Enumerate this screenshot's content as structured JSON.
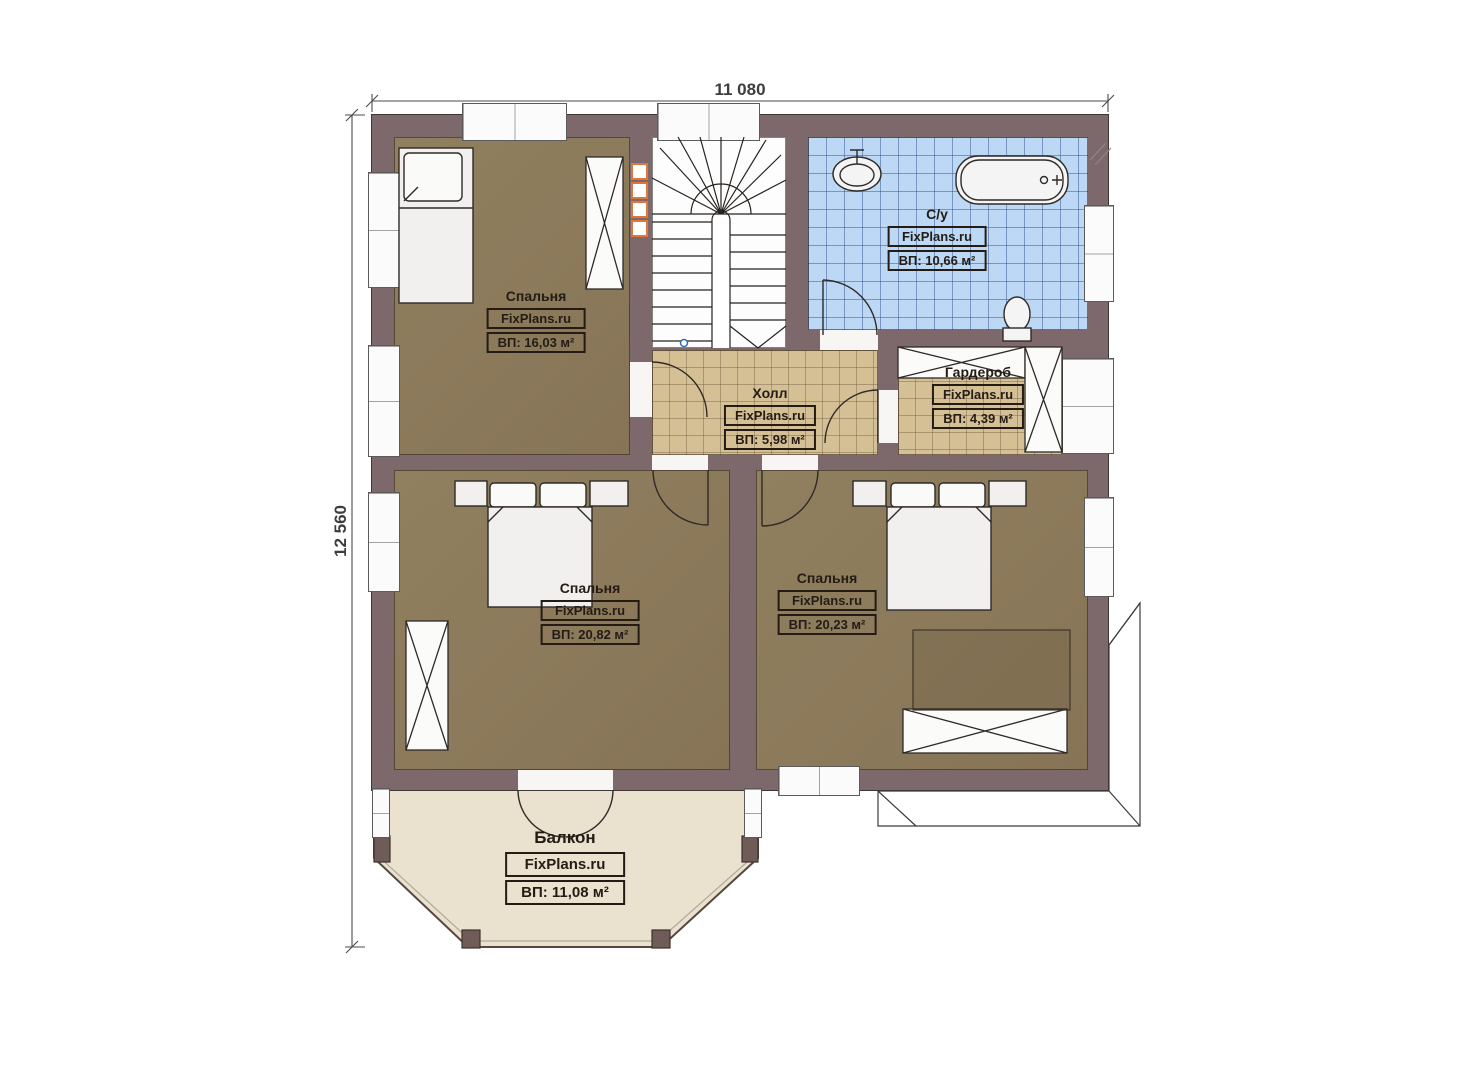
{
  "watermark": "FixPlans.ru",
  "dimensions": {
    "top": "11 080",
    "left": "12 560"
  },
  "rooms": [
    {
      "key": "bedroom_top_left",
      "name": "Спальня",
      "watermark": "FixPlans.ru",
      "area": "ВП: 16,03 м²"
    },
    {
      "key": "bathroom",
      "name": "С/у",
      "watermark": "FixPlans.ru",
      "area": "ВП: 10,66 м²"
    },
    {
      "key": "hall",
      "name": "Холл",
      "watermark": "FixPlans.ru",
      "area": "ВП: 5,98 м²"
    },
    {
      "key": "wardrobe",
      "name": "Гардероб",
      "watermark": "FixPlans.ru",
      "area": "ВП: 4,39 м²"
    },
    {
      "key": "bedroom_bottom_left",
      "name": "Спальня",
      "watermark": "FixPlans.ru",
      "area": "ВП: 20,82 м²"
    },
    {
      "key": "bedroom_bottom_right",
      "name": "Спальня",
      "watermark": "FixPlans.ru",
      "area": "ВП: 20,23 м²"
    },
    {
      "key": "balcony",
      "name": "Балкон",
      "watermark": "FixPlans.ru",
      "area": "ВП: 11,08 м²"
    }
  ],
  "colors": {
    "wall": "#7d696b",
    "floor_wood": "#8d7b5f",
    "floor_tile": "#d5c096",
    "floor_bath": "#bcd8f4",
    "floor_balcony": "#eae2cf",
    "accent_orange": "#e0763c",
    "line": "#2b2420"
  }
}
